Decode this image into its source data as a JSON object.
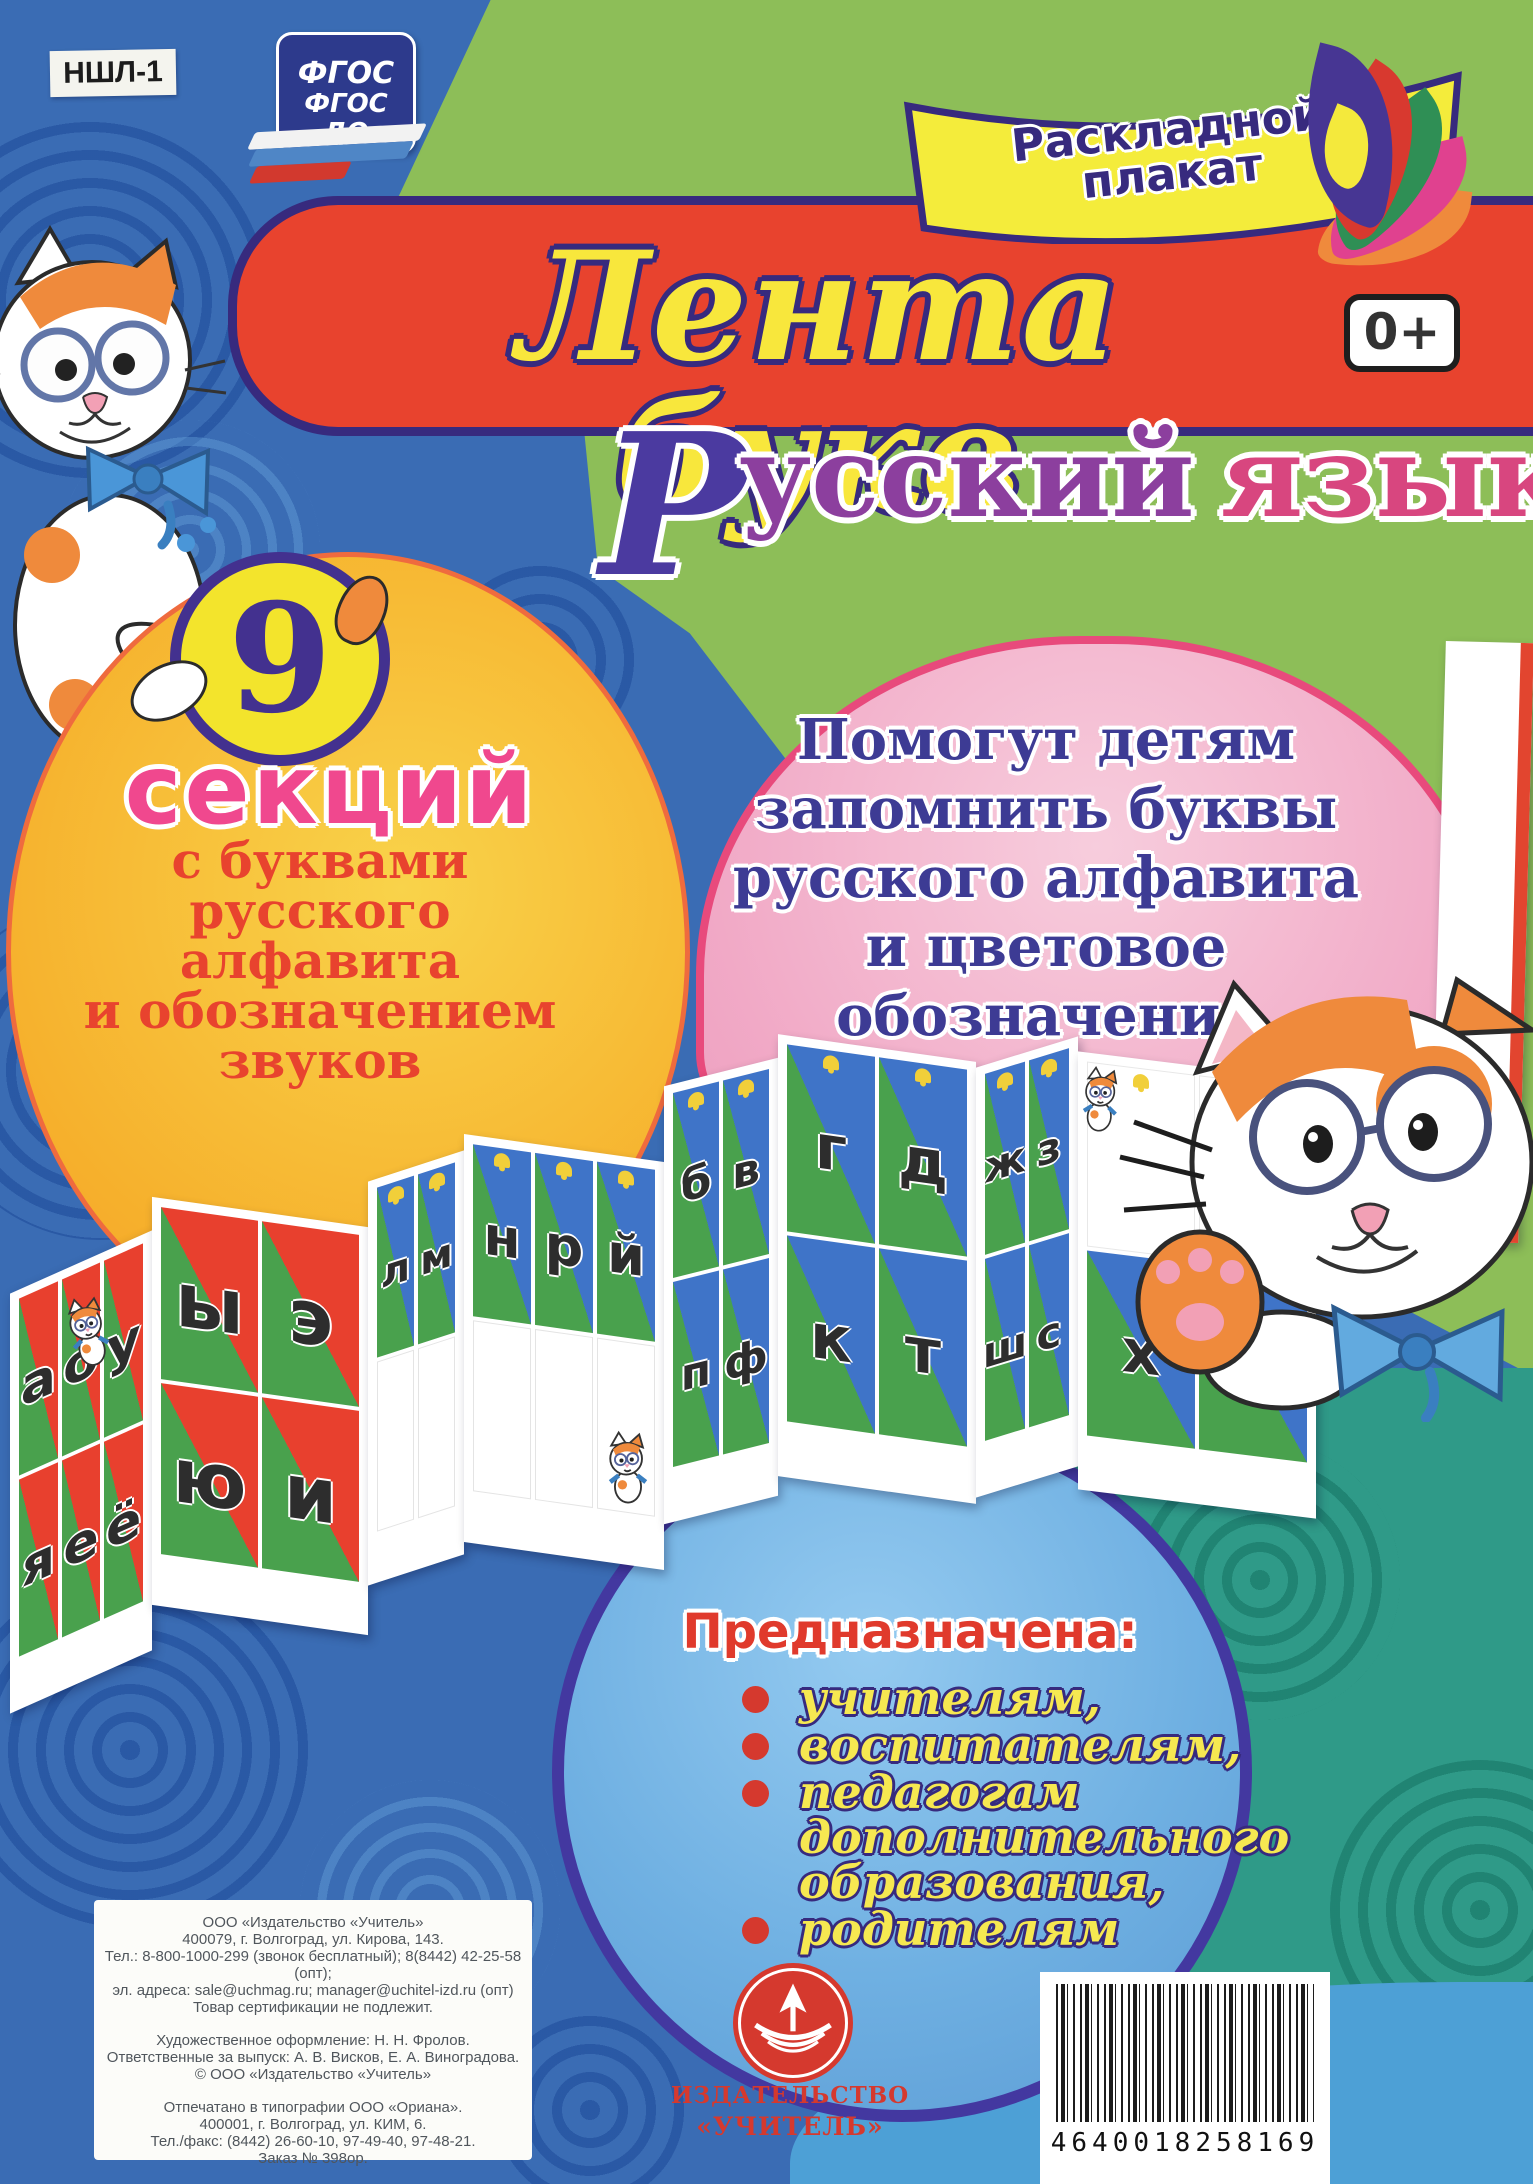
{
  "product_code": "НШЛ-1",
  "fgos_badge": {
    "line1": "ФГОС",
    "line2": "ФГОС ДО"
  },
  "corner_ribbon": {
    "line1": "Раскладной",
    "line2": "плакат"
  },
  "title": "Лента букв",
  "age_rating": "0+",
  "subtitle": {
    "initial": "Р",
    "word1_rest": "усский",
    "word2": "язык"
  },
  "sections_bubble": {
    "count": "9",
    "count_label": "секций",
    "lines": [
      "с буквами",
      "русского",
      "алфавита",
      "и обозначением",
      "звуков"
    ]
  },
  "benefit_bubble": {
    "lines": [
      "Помогут детям",
      "запомнить буквы",
      "русского алфавита",
      "и цветовое",
      "обозначение звуков"
    ]
  },
  "audience": {
    "heading": "Предназначена:",
    "items": [
      "учителям,",
      "воспитателям,",
      "педагогам дополнительного образования,",
      "родителям"
    ]
  },
  "letter_ribbon": {
    "panels": [
      {
        "style": "red",
        "bells": false,
        "rows": [
          [
            "а",
            "о",
            "у"
          ],
          [
            "я",
            "е",
            "ё"
          ]
        ]
      },
      {
        "style": "red",
        "bells": false,
        "rows": [
          [
            "ы",
            "э"
          ],
          [
            "ю",
            "и"
          ]
        ]
      },
      {
        "style": "blue",
        "bells": true,
        "rows": [
          [
            "л",
            "м"
          ],
          [
            "",
            ""
          ]
        ]
      },
      {
        "style": "blue",
        "bells": true,
        "rows": [
          [
            "н",
            "р",
            "й"
          ],
          [
            "",
            "",
            ""
          ]
        ]
      },
      {
        "style": "blue",
        "bells": true,
        "rows": [
          [
            "б",
            "в"
          ],
          [
            "п",
            "ф"
          ]
        ]
      },
      {
        "style": "blue",
        "bells": true,
        "rows": [
          [
            "г",
            "д"
          ],
          [
            "к",
            "т"
          ]
        ]
      },
      {
        "style": "blue",
        "bells": true,
        "rows": [
          [
            "ж",
            "з"
          ],
          [
            "ш",
            "с"
          ]
        ]
      },
      {
        "style": "white-top",
        "bells": true,
        "rows": [
          [
            "",
            ""
          ],
          [
            "х",
            "ц"
          ]
        ]
      },
      {
        "style": "white-edge",
        "bells": false,
        "rows": [
          [
            ""
          ],
          [
            ""
          ]
        ]
      }
    ]
  },
  "imprint": {
    "blocks": [
      [
        "ООО «Издательство «Учитель»",
        "400079, г. Волгоград, ул. Кирова, 143.",
        "Тел.: 8-800-1000-299 (звонок бесплатный); 8(8442) 42-25-58 (опт);",
        "эл. адреса: sale@uchmag.ru; manager@uchitel-izd.ru (опт)",
        "Товар сертификации не подлежит."
      ],
      [
        "Художественное оформление: Н. Н. Фролов.",
        "Ответственные за выпуск: А. В. Висков, Е. А. Виноградова.",
        "© ООО «Издательство «Учитель»"
      ],
      [
        "Отпечатано в типографии ООО «Ориана».",
        "400001, г. Волгоград, ул. КИМ, 6.",
        "Тел./факс: (8442) 26-60-10, 97-49-40, 97-48-21.",
        "Заказ № 398ор."
      ]
    ]
  },
  "publisher": {
    "logo_line1": "ИЗДАТЕЛЬСТВО",
    "logo_line2": "«УЧИТЕЛЬ»"
  },
  "barcode": {
    "number": "4640018258169"
  },
  "colors": {
    "background_blue": "#3a6cb4",
    "green_band": "#8dbe58",
    "teal_corner": "#2f9a88",
    "banner_red": "#e8432e",
    "banner_border_navy": "#372a7e",
    "title_yellow": "#f8e73c",
    "pink_accent": "#f0488e",
    "bubble_pink": "#f1a9c6",
    "bubble_orange": "#f6b02c",
    "audience_blue": "#6fb0e2",
    "cell_blue": "#3f74c8",
    "cell_green": "#49a14d",
    "cell_red": "#e8402e",
    "logo_red": "#d5392e"
  }
}
